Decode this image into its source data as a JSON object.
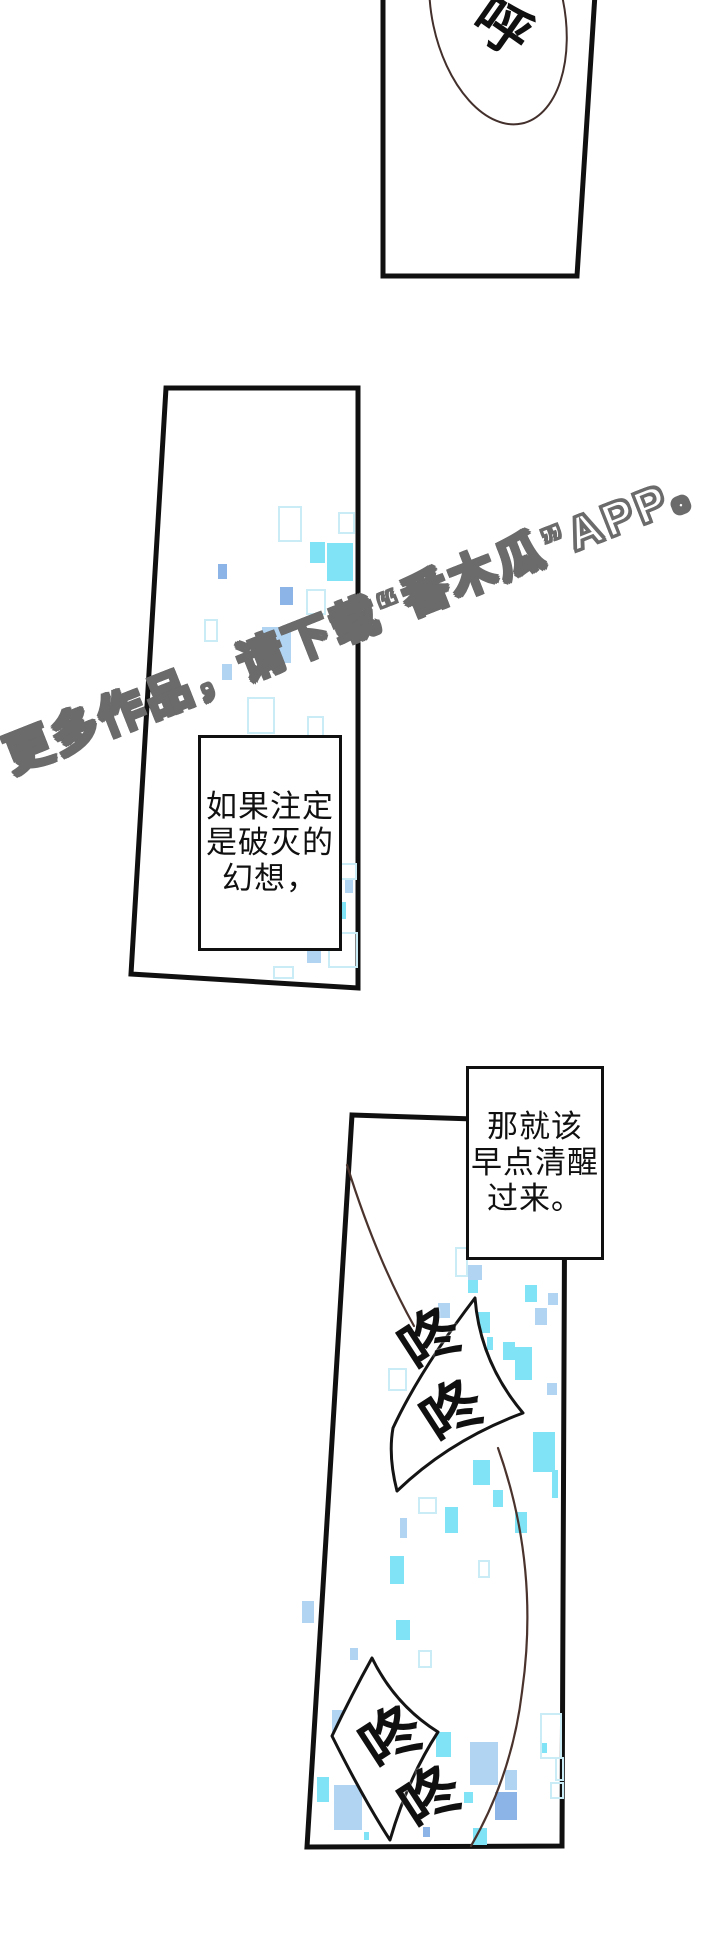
{
  "page": {
    "width": 720,
    "height": 1944,
    "background": "#ffffff"
  },
  "colors": {
    "ink": "#101010",
    "panel_bg": "#ffffff",
    "bubble_stroke": "#141414",
    "strand_brown": "#4a332c",
    "ellipse_stroke": "#43302c",
    "wm_fill": "#ffffff",
    "wm_outline": "#6b6b6b",
    "sp_cyan": "#80e4f6",
    "sp_blue": "#a9cff2",
    "sp_mid": "#8cb4e6",
    "sp_outline": "#c9ecf7"
  },
  "watermark": {
    "text": "更多作品，请下载“番木瓜”APP。"
  },
  "sfx": {
    "top_bubble": "呼",
    "upper": [
      "咚",
      "咚"
    ],
    "lower": [
      "咚",
      "咚"
    ]
  },
  "speech_boxes": [
    {
      "lines": [
        "如果注定",
        "是破灭的",
        "幻想，"
      ]
    },
    {
      "lines": [
        "那就该",
        "早点清醒",
        "过来。"
      ]
    }
  ],
  "sparkles": {
    "items": [
      {
        "x": 278,
        "y": 506,
        "w": 20,
        "h": 32,
        "s": "o"
      },
      {
        "x": 310,
        "y": 542,
        "w": 15,
        "h": 21,
        "s": "a"
      },
      {
        "x": 327,
        "y": 543,
        "w": 26,
        "h": 38,
        "s": "a"
      },
      {
        "x": 338,
        "y": 512,
        "w": 13,
        "h": 18,
        "s": "o"
      },
      {
        "x": 218,
        "y": 564,
        "w": 9,
        "h": 15,
        "s": "d"
      },
      {
        "x": 280,
        "y": 587,
        "w": 13,
        "h": 18,
        "s": "d"
      },
      {
        "x": 306,
        "y": 589,
        "w": 16,
        "h": 22,
        "s": "o"
      },
      {
        "x": 204,
        "y": 619,
        "w": 10,
        "h": 19,
        "s": "o"
      },
      {
        "x": 262,
        "y": 627,
        "w": 29,
        "h": 36,
        "s": "b"
      },
      {
        "x": 222,
        "y": 664,
        "w": 10,
        "h": 16,
        "s": "b"
      },
      {
        "x": 247,
        "y": 697,
        "w": 24,
        "h": 33,
        "s": "o"
      },
      {
        "x": 307,
        "y": 716,
        "w": 13,
        "h": 19,
        "s": "o"
      },
      {
        "x": 336,
        "y": 863,
        "w": 17,
        "h": 13,
        "s": "o"
      },
      {
        "x": 336,
        "y": 902,
        "w": 10,
        "h": 17,
        "s": "a"
      },
      {
        "x": 328,
        "y": 932,
        "w": 26,
        "h": 32,
        "s": "o"
      },
      {
        "x": 307,
        "y": 949,
        "w": 14,
        "h": 14,
        "s": "b"
      },
      {
        "x": 273,
        "y": 966,
        "w": 17,
        "h": 9,
        "s": "o"
      },
      {
        "x": 345,
        "y": 880,
        "w": 8,
        "h": 13,
        "s": "b"
      },
      {
        "x": 455,
        "y": 1247,
        "w": 9,
        "h": 26,
        "s": "o"
      },
      {
        "x": 468,
        "y": 1265,
        "w": 14,
        "h": 15,
        "s": "b"
      },
      {
        "x": 468,
        "y": 1280,
        "w": 10,
        "h": 13,
        "s": "a"
      },
      {
        "x": 525,
        "y": 1285,
        "w": 12,
        "h": 17,
        "s": "a"
      },
      {
        "x": 548,
        "y": 1293,
        "w": 10,
        "h": 12,
        "s": "b"
      },
      {
        "x": 438,
        "y": 1303,
        "w": 12,
        "h": 15,
        "s": "b"
      },
      {
        "x": 478,
        "y": 1312,
        "w": 12,
        "h": 21,
        "s": "a"
      },
      {
        "x": 535,
        "y": 1308,
        "w": 12,
        "h": 17,
        "s": "b"
      },
      {
        "x": 487,
        "y": 1337,
        "w": 6,
        "h": 13,
        "s": "a"
      },
      {
        "x": 503,
        "y": 1342,
        "w": 12,
        "h": 18,
        "s": "a"
      },
      {
        "x": 515,
        "y": 1347,
        "w": 17,
        "h": 33,
        "s": "a"
      },
      {
        "x": 547,
        "y": 1383,
        "w": 10,
        "h": 12,
        "s": "b"
      },
      {
        "x": 388,
        "y": 1368,
        "w": 15,
        "h": 19,
        "s": "o"
      },
      {
        "x": 533,
        "y": 1432,
        "w": 22,
        "h": 40,
        "s": "a"
      },
      {
        "x": 473,
        "y": 1460,
        "w": 17,
        "h": 25,
        "s": "a"
      },
      {
        "x": 493,
        "y": 1490,
        "w": 10,
        "h": 17,
        "s": "a"
      },
      {
        "x": 515,
        "y": 1512,
        "w": 12,
        "h": 21,
        "s": "a"
      },
      {
        "x": 418,
        "y": 1497,
        "w": 15,
        "h": 13,
        "s": "o"
      },
      {
        "x": 400,
        "y": 1518,
        "w": 7,
        "h": 20,
        "s": "b"
      },
      {
        "x": 445,
        "y": 1507,
        "w": 13,
        "h": 26,
        "s": "a"
      },
      {
        "x": 552,
        "y": 1470,
        "w": 6,
        "h": 28,
        "s": "a"
      },
      {
        "x": 390,
        "y": 1556,
        "w": 14,
        "h": 28,
        "s": "a"
      },
      {
        "x": 302,
        "y": 1601,
        "w": 12,
        "h": 22,
        "s": "b"
      },
      {
        "x": 396,
        "y": 1620,
        "w": 14,
        "h": 20,
        "s": "a"
      },
      {
        "x": 418,
        "y": 1650,
        "w": 10,
        "h": 14,
        "s": "o"
      },
      {
        "x": 350,
        "y": 1648,
        "w": 8,
        "h": 12,
        "s": "b"
      },
      {
        "x": 478,
        "y": 1560,
        "w": 8,
        "h": 14,
        "s": "o"
      },
      {
        "x": 332,
        "y": 1710,
        "w": 18,
        "h": 22,
        "s": "b"
      },
      {
        "x": 317,
        "y": 1777,
        "w": 12,
        "h": 25,
        "s": "a"
      },
      {
        "x": 334,
        "y": 1785,
        "w": 28,
        "h": 45,
        "s": "b"
      },
      {
        "x": 364,
        "y": 1832,
        "w": 5,
        "h": 8,
        "s": "a"
      },
      {
        "x": 436,
        "y": 1732,
        "w": 15,
        "h": 25,
        "s": "a"
      },
      {
        "x": 423,
        "y": 1827,
        "w": 7,
        "h": 10,
        "s": "d"
      },
      {
        "x": 470,
        "y": 1742,
        "w": 28,
        "h": 43,
        "s": "b"
      },
      {
        "x": 464,
        "y": 1792,
        "w": 9,
        "h": 11,
        "s": "a"
      },
      {
        "x": 495,
        "y": 1792,
        "w": 22,
        "h": 28,
        "s": "d"
      },
      {
        "x": 505,
        "y": 1770,
        "w": 12,
        "h": 20,
        "s": "b"
      },
      {
        "x": 473,
        "y": 1828,
        "w": 14,
        "h": 17,
        "s": "a"
      },
      {
        "x": 540,
        "y": 1713,
        "w": 18,
        "h": 42,
        "s": "o"
      },
      {
        "x": 542,
        "y": 1743,
        "w": 5,
        "h": 10,
        "s": "a"
      },
      {
        "x": 550,
        "y": 1782,
        "w": 10,
        "h": 13,
        "s": "o"
      },
      {
        "x": 555,
        "y": 1757,
        "w": 5,
        "h": 20,
        "s": "o"
      }
    ]
  }
}
